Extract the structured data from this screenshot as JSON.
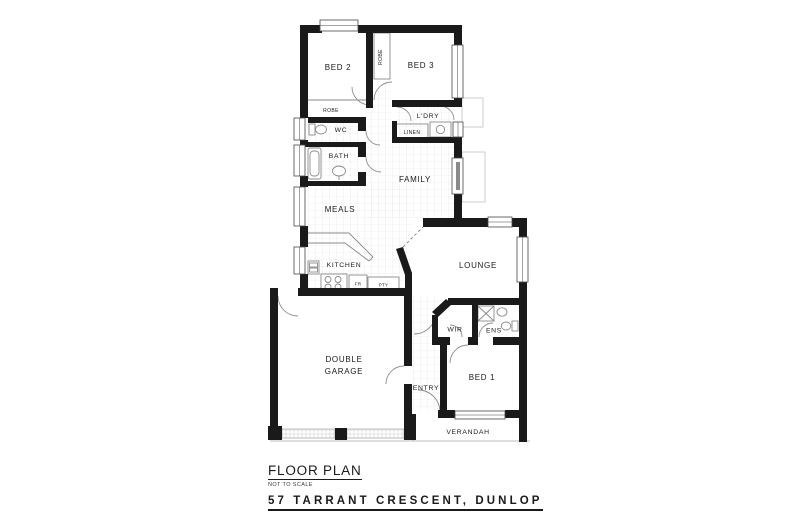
{
  "document": {
    "heading": "FLOOR PLAN",
    "scale_note": "NOT TO SCALE",
    "address": "57 TARRANT CRESCENT, DUNLOP"
  },
  "rooms": {
    "bed2": "BED 2",
    "bed3": "BED 3",
    "bed1": "BED 1",
    "robe_between": "ROBE",
    "robe_bed2": "ROBE",
    "wc": "WC",
    "bath": "BATH",
    "laundry": "L'DRY",
    "linen": "LINEN",
    "family": "FAMILY",
    "meals": "MEALS",
    "kitchen": "KITCHEN",
    "fridge": "FR",
    "pantry": "PTY",
    "lounge": "LOUNGE",
    "wir": "WIR",
    "ens": "ENS",
    "garage_line1": "DOUBLE",
    "garage_line2": "GARAGE",
    "entry": "ENTRY",
    "verandah": "VERANDAH"
  },
  "colors": {
    "wall": "#1a1a1a",
    "fixture": "#8a8a8a",
    "tile": "#e2e2e2",
    "outdoor": "#cccccc",
    "background": "#ffffff",
    "text": "#1a1a1a"
  }
}
